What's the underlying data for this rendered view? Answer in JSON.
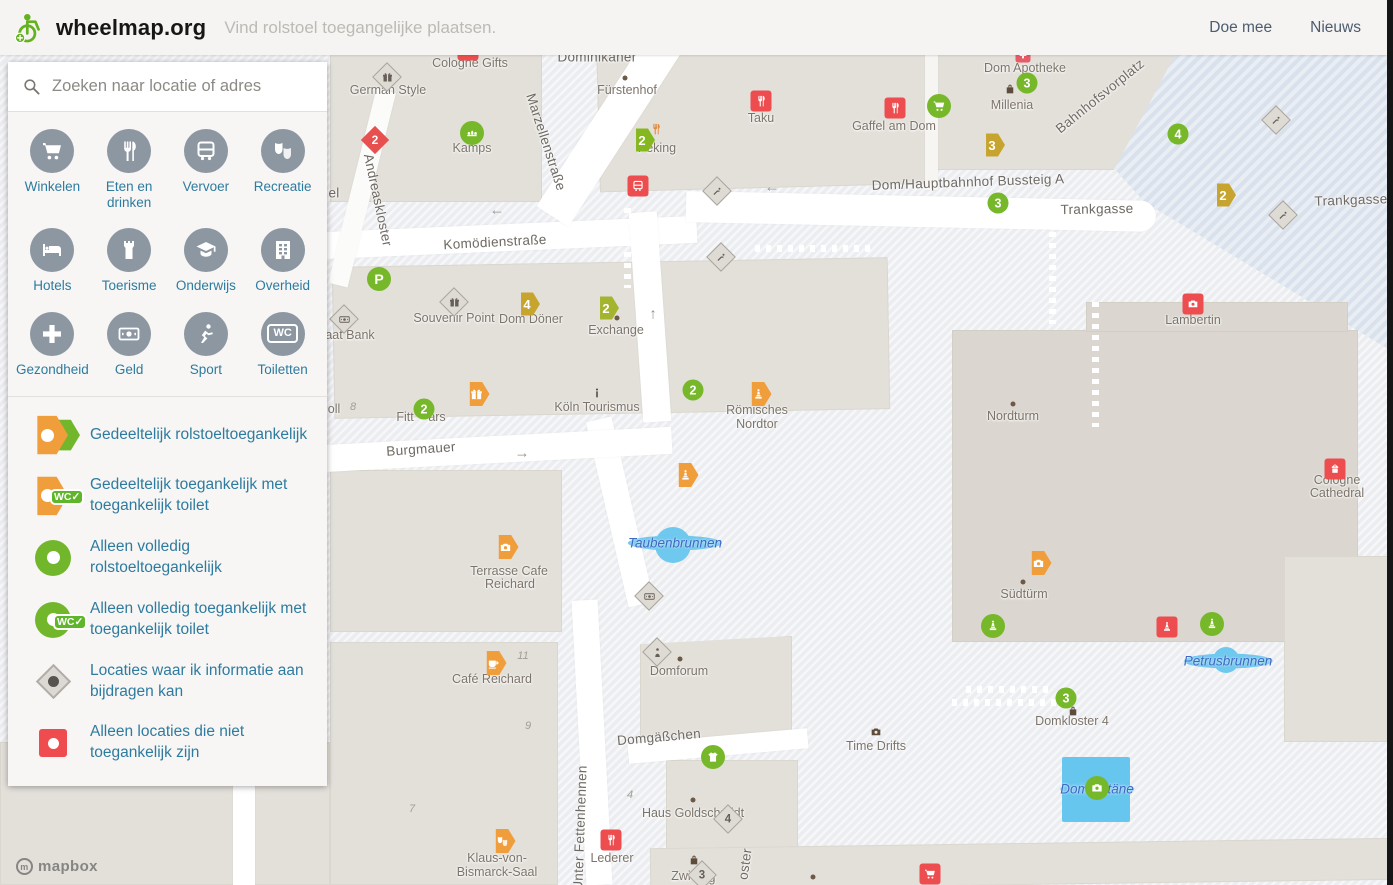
{
  "header": {
    "brand": "wheelmap.org",
    "tagline": "Vind rolstoel toegangelijke plaatsen.",
    "nav": [
      "Doe mee",
      "Nieuws"
    ]
  },
  "sidebar": {
    "search_placeholder": "Zoeken naar locatie of adres",
    "wc_badge": "WC✓",
    "wc_icon_text": "WC",
    "categories": [
      {
        "id": "winkelen",
        "label": "Winkelen",
        "icon": "cart"
      },
      {
        "id": "eten-en-drinken",
        "label": "Eten en drinken",
        "icon": "fork"
      },
      {
        "id": "vervoer",
        "label": "Vervoer",
        "icon": "bus"
      },
      {
        "id": "recreatie",
        "label": "Recreatie",
        "icon": "masks"
      },
      {
        "id": "hotels",
        "label": "Hotels",
        "icon": "bed"
      },
      {
        "id": "toerisme",
        "label": "Toerisme",
        "icon": "castle"
      },
      {
        "id": "onderwijs",
        "label": "Onderwijs",
        "icon": "grad"
      },
      {
        "id": "overheid",
        "label": "Overheid",
        "icon": "gov"
      },
      {
        "id": "gezondheid",
        "label": "Gezondheid",
        "icon": "plus"
      },
      {
        "id": "geld",
        "label": "Geld",
        "icon": "money"
      },
      {
        "id": "sport",
        "label": "Sport",
        "icon": "sport"
      },
      {
        "id": "toiletten",
        "label": "Toiletten",
        "icon": "wc"
      }
    ],
    "legend": [
      {
        "label": "Gedeeltelijk rolstoeltoegankelijk"
      },
      {
        "label": "Gedeeltelijk toegankelijk met toegankelijk toilet"
      },
      {
        "label": "Alleen volledig rolstoeltoegankelijk"
      },
      {
        "label": "Alleen volledig toegankelijk met toegankelijk toilet"
      },
      {
        "label": "Locaties waar ik informatie aan bijdragen kan"
      },
      {
        "label": "Alleen locaties die niet toegankelijk zijn"
      }
    ]
  },
  "map": {
    "attribution": "mapbox",
    "labels": [
      {
        "s": "Dominikaner",
        "c": "street",
        "x": 597,
        "y": 57
      },
      {
        "s": "Komödienstraße",
        "c": "street",
        "x": 495,
        "y": 242,
        "r": -3
      },
      {
        "s": "Marzellenstraße",
        "c": "street",
        "x": 546,
        "y": 142,
        "r": 72
      },
      {
        "s": "Andreaskloster",
        "c": "street",
        "x": 378,
        "y": 200,
        "r": 78
      },
      {
        "s": "el",
        "c": "street",
        "x": 334,
        "y": 193
      },
      {
        "s": "Trankgasse",
        "c": "street",
        "x": 1097,
        "y": 209,
        "r": -1
      },
      {
        "s": "Trankgasse",
        "c": "street",
        "x": 1351,
        "y": 200,
        "r": -2
      },
      {
        "s": "Bahnhofsvorplatz",
        "c": "street",
        "x": 1100,
        "y": 96,
        "r": -39
      },
      {
        "s": "Dom/Hauptbahnhof Bussteig A",
        "c": "street",
        "x": 968,
        "y": 182,
        "r": -2
      },
      {
        "s": "Burgmauer",
        "c": "street",
        "x": 421,
        "y": 449,
        "r": -4
      },
      {
        "s": "Domgäßchen",
        "c": "street",
        "x": 659,
        "y": 737,
        "r": -5
      },
      {
        "s": "Unter Fettenhennen",
        "c": "street",
        "x": 580,
        "y": 828,
        "r": -88
      },
      {
        "s": "oster",
        "c": "street",
        "x": 745,
        "y": 864,
        "r": -82
      },
      {
        "s": "Cologne Gifts",
        "c": "poi",
        "x": 470,
        "y": 63
      },
      {
        "s": "German Style",
        "c": "poi",
        "x": 388,
        "y": 90
      },
      {
        "s": "Kamps",
        "c": "poi",
        "x": 472,
        "y": 148
      },
      {
        "s": "Fürstenhof",
        "c": "poi",
        "x": 627,
        "y": 90
      },
      {
        "s": "Taku",
        "c": "poi",
        "x": 761,
        "y": 118
      },
      {
        "s": "Peking",
        "c": "poi",
        "x": 657,
        "y": 148
      },
      {
        "s": "Dom Apotheke",
        "c": "poi",
        "x": 1025,
        "y": 68
      },
      {
        "s": "Millenia",
        "c": "poi",
        "x": 1012,
        "y": 105
      },
      {
        "s": "Gaffel am Dom",
        "c": "poi",
        "x": 894,
        "y": 126
      },
      {
        "s": "Souvenir Point",
        "c": "poi",
        "x": 454,
        "y": 318
      },
      {
        "s": "Dom Döner",
        "c": "poi",
        "x": 531,
        "y": 319
      },
      {
        "s": "Exchange",
        "c": "poi",
        "x": 616,
        "y": 330
      },
      {
        "s": "aat Bank",
        "c": "poi",
        "x": 350,
        "y": 335
      },
      {
        "s": "oll",
        "c": "poi",
        "x": 334,
        "y": 409
      },
      {
        "s": "Fitt",
        "c": "poi",
        "x": 405,
        "y": 417
      },
      {
        "s": "ars",
        "c": "poi",
        "x": 437,
        "y": 417
      },
      {
        "s": "Köln Tourismus",
        "c": "poi",
        "x": 597,
        "y": 407
      },
      {
        "s": "Römisches",
        "c": "poi",
        "x": 757,
        "y": 410
      },
      {
        "s": "Nordtor",
        "c": "poi",
        "x": 757,
        "y": 424
      },
      {
        "s": "Terrasse Cafe",
        "c": "poi",
        "x": 509,
        "y": 571
      },
      {
        "s": "Reichard",
        "c": "poi",
        "x": 510,
        "y": 584
      },
      {
        "s": "Café Reichard",
        "c": "poi",
        "x": 492,
        "y": 679
      },
      {
        "s": "Domforum",
        "c": "poi",
        "x": 679,
        "y": 671
      },
      {
        "s": "Haus Goldschmidt",
        "c": "poi",
        "x": 693,
        "y": 813
      },
      {
        "s": "Lederer",
        "c": "poi",
        "x": 612,
        "y": 858
      },
      {
        "s": "Klaus-von-",
        "c": "poi",
        "x": 497,
        "y": 858
      },
      {
        "s": "Bismarck-Saal",
        "c": "poi",
        "x": 497,
        "y": 872
      },
      {
        "s": "Zwi",
        "c": "poi",
        "x": 681,
        "y": 876
      },
      {
        "s": "g",
        "c": "poi",
        "x": 712,
        "y": 878
      },
      {
        "s": "Nordturm",
        "c": "poi",
        "x": 1013,
        "y": 416
      },
      {
        "s": "Lambertin",
        "c": "poi",
        "x": 1193,
        "y": 320
      },
      {
        "s": "Cologne",
        "c": "poi",
        "x": 1337,
        "y": 480
      },
      {
        "s": "Cathedral",
        "c": "poi",
        "x": 1337,
        "y": 493
      },
      {
        "s": "Südtürm",
        "c": "poi",
        "x": 1024,
        "y": 594
      },
      {
        "s": "Domkloster 4",
        "c": "poi",
        "x": 1072,
        "y": 721
      },
      {
        "s": "Time Drifts",
        "c": "poi",
        "x": 876,
        "y": 746
      },
      {
        "s": "Taubenbrunnen",
        "c": "water",
        "x": 675,
        "y": 543
      },
      {
        "s": "Petrusbrunnen",
        "c": "water",
        "x": 1228,
        "y": 661
      },
      {
        "s": "Domfontäne",
        "c": "water",
        "x": 1097,
        "y": 789
      },
      {
        "s": "11",
        "c": "num",
        "x": 523,
        "y": 656
      },
      {
        "s": "9",
        "c": "num",
        "x": 528,
        "y": 726
      },
      {
        "s": "7",
        "c": "num",
        "x": 412,
        "y": 809
      },
      {
        "s": "4",
        "c": "num",
        "x": 630,
        "y": 795
      },
      {
        "s": "8",
        "c": "num",
        "x": 353,
        "y": 407
      },
      {
        "s": "←",
        "c": "arrow",
        "x": 772,
        "y": 187
      },
      {
        "s": "←",
        "c": "arrow",
        "x": 497,
        "y": 210
      },
      {
        "s": "↑",
        "c": "arrow",
        "x": 653,
        "y": 314
      },
      {
        "s": "→",
        "c": "arrow",
        "x": 522,
        "y": 453
      }
    ],
    "markers": [
      {
        "n": "cologne-gifts",
        "t": "rs",
        "i": "bag",
        "x": 468,
        "y": 50
      },
      {
        "n": "german-style",
        "t": "dg",
        "i": "gift",
        "x": 387,
        "y": 77
      },
      {
        "n": "kamps",
        "t": "gc",
        "i": "bread",
        "x": 472,
        "y": 133
      },
      {
        "n": "fuerstenhof-dot",
        "t": "dot",
        "x": 625,
        "y": 78
      },
      {
        "n": "taku",
        "t": "rs",
        "i": "fork",
        "x": 761,
        "y": 101
      },
      {
        "n": "peking-cluster",
        "t": "hxgr",
        "c": "2",
        "x": 642,
        "y": 140
      },
      {
        "n": "peking-food",
        "t": "bi",
        "i": "fork",
        "x": 656,
        "y": 129,
        "col": "#e2893b"
      },
      {
        "n": "tram-stop",
        "t": "rs",
        "i": "bus",
        "x": 638,
        "y": 186
      },
      {
        "n": "andreas-cluster",
        "t": "dr",
        "c": "2",
        "x": 375,
        "y": 140
      },
      {
        "n": "escalator-1",
        "t": "dg",
        "i": "esc",
        "x": 717,
        "y": 191
      },
      {
        "n": "escalator-2",
        "t": "dg",
        "i": "esc",
        "x": 721,
        "y": 257
      },
      {
        "n": "dom-apotheke",
        "t": "rsp",
        "i": "plus",
        "x": 1023,
        "y": 55
      },
      {
        "n": "cluster-3a",
        "t": "gn",
        "c": "3",
        "x": 1027,
        "y": 83
      },
      {
        "n": "millenia",
        "t": "bi",
        "i": "bag",
        "x": 1010,
        "y": 89
      },
      {
        "n": "shop-cart",
        "t": "gc",
        "i": "cart",
        "x": 939,
        "y": 106
      },
      {
        "n": "gaffel-am-dom",
        "t": "rs",
        "i": "fork",
        "x": 895,
        "y": 108
      },
      {
        "n": "bussteig-hex3",
        "t": "hxg",
        "c": "3",
        "x": 992,
        "y": 145
      },
      {
        "n": "cluster-3b",
        "t": "gn",
        "c": "3",
        "x": 998,
        "y": 203
      },
      {
        "n": "cluster-4a",
        "t": "gn",
        "c": "4",
        "x": 1178,
        "y": 134
      },
      {
        "n": "trankgasse-hex2",
        "t": "hxg",
        "c": "2",
        "x": 1223,
        "y": 195
      },
      {
        "n": "escalator-3",
        "t": "dg",
        "i": "esc",
        "x": 1276,
        "y": 120
      },
      {
        "n": "escalator-4",
        "t": "dg",
        "i": "esc",
        "x": 1283,
        "y": 215
      },
      {
        "n": "parking",
        "t": "gc",
        "c": "P",
        "x": 379,
        "y": 279
      },
      {
        "n": "bank",
        "t": "dg",
        "i": "money",
        "x": 344,
        "y": 319
      },
      {
        "n": "souvenir-point",
        "t": "dg",
        "i": "gift",
        "x": 454,
        "y": 302
      },
      {
        "n": "dom-doener-hex4",
        "t": "hxg",
        "c": "4",
        "x": 527,
        "y": 304
      },
      {
        "n": "exchange-hex2",
        "t": "hxog",
        "c": "2",
        "x": 606,
        "y": 308
      },
      {
        "n": "exchange-dot",
        "t": "dot",
        "x": 617,
        "y": 318
      },
      {
        "n": "cluster-2a",
        "t": "gn",
        "c": "2",
        "x": 693,
        "y": 390
      },
      {
        "n": "roemisches-nordtor",
        "t": "hxo",
        "i": "statue",
        "x": 758,
        "y": 394
      },
      {
        "n": "gift-hex",
        "t": "hxo",
        "i": "gift",
        "x": 476,
        "y": 394
      },
      {
        "n": "fitt-cluster-2",
        "t": "gn",
        "c": "2",
        "x": 424,
        "y": 409
      },
      {
        "n": "koeln-tourismus",
        "t": "bi",
        "i": "info",
        "x": 597,
        "y": 393,
        "col": "#4a4540"
      },
      {
        "n": "statue-hex",
        "t": "hxo",
        "i": "statue",
        "x": 685,
        "y": 475
      },
      {
        "n": "terrasse-cafe-reichard",
        "t": "hxo",
        "i": "camera",
        "x": 505,
        "y": 547
      },
      {
        "n": "money-diamond",
        "t": "dg",
        "i": "money",
        "x": 649,
        "y": 596
      },
      {
        "n": "cafe-reichard",
        "t": "hxo",
        "i": "coffee",
        "x": 493,
        "y": 663
      },
      {
        "n": "domforum",
        "t": "dg",
        "i": "person",
        "x": 657,
        "y": 652
      },
      {
        "n": "domforum-dot",
        "t": "dot",
        "x": 680,
        "y": 659
      },
      {
        "n": "tshirt-shop",
        "t": "gc",
        "i": "tshirt",
        "x": 713,
        "y": 757
      },
      {
        "n": "hausgoldschmidt-dot",
        "t": "dot",
        "x": 693,
        "y": 800
      },
      {
        "n": "hausgoldschmidt-4",
        "t": "dg",
        "c": "4",
        "x": 728,
        "y": 819
      },
      {
        "n": "lederer",
        "t": "rs",
        "i": "fork",
        "x": 611,
        "y": 840
      },
      {
        "n": "bismarck-saal",
        "t": "hxo",
        "i": "masks",
        "x": 502,
        "y": 841
      },
      {
        "n": "zwi-bag",
        "t": "bi",
        "i": "bag",
        "x": 694,
        "y": 860
      },
      {
        "n": "zwi-3",
        "t": "dg",
        "c": "3",
        "x": 702,
        "y": 875
      },
      {
        "n": "nordturm-dot",
        "t": "dot",
        "x": 1013,
        "y": 404
      },
      {
        "n": "lambertin",
        "t": "rs",
        "i": "camera",
        "x": 1193,
        "y": 304
      },
      {
        "n": "cologne-cathedral",
        "t": "rs",
        "i": "church",
        "x": 1335,
        "y": 469
      },
      {
        "n": "suedturm-camera",
        "t": "hxo",
        "i": "camera",
        "x": 1038,
        "y": 563
      },
      {
        "n": "suedturm-dot",
        "t": "dot",
        "x": 1023,
        "y": 582
      },
      {
        "n": "statue-green-1",
        "t": "gc",
        "i": "statue",
        "x": 993,
        "y": 626
      },
      {
        "n": "statue-red",
        "t": "rs",
        "i": "statue",
        "x": 1167,
        "y": 627
      },
      {
        "n": "statue-green-2",
        "t": "gc",
        "i": "statue",
        "x": 1212,
        "y": 624
      },
      {
        "n": "domkloster-3",
        "t": "gn",
        "c": "3",
        "x": 1066,
        "y": 698
      },
      {
        "n": "domkloster-bag",
        "t": "bi",
        "i": "bag",
        "x": 1073,
        "y": 711
      },
      {
        "n": "fontaene-camera",
        "t": "gc",
        "i": "camera",
        "x": 1097,
        "y": 788
      },
      {
        "n": "time-drifts",
        "t": "bi",
        "i": "camera",
        "x": 876,
        "y": 732
      },
      {
        "n": "bottom-dot",
        "t": "dot",
        "x": 813,
        "y": 877
      },
      {
        "n": "red-cart",
        "t": "rs",
        "i": "cart",
        "x": 930,
        "y": 874
      }
    ]
  }
}
